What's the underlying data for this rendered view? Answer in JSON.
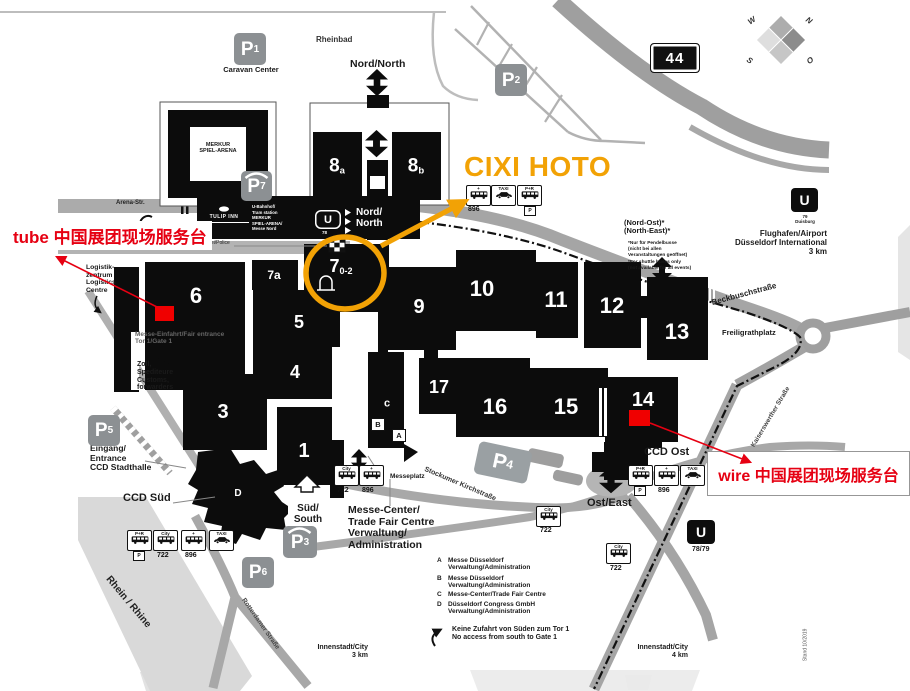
{
  "annotations": {
    "cixi_label": "CIXI HOTO",
    "tube_label": "tube 中国展团现场服务台",
    "wire_label": "wire 中国展团现场服务台"
  },
  "compass": {
    "w": "W",
    "n": "N",
    "s": "S",
    "o": "O"
  },
  "highway": {
    "sign": "44"
  },
  "halls": {
    "h1": "1",
    "h3": "3",
    "h4": "4",
    "h5": "5",
    "h6": "6",
    "h7": "7",
    "h7_sub": "0-2",
    "h7a": "7a",
    "h8": "8",
    "h8a_sub": "a",
    "h8b_sub": "b",
    "h9": "9",
    "h10": "10",
    "h11": "11",
    "h12": "12",
    "h13": "13",
    "h14": "14",
    "h15": "15",
    "h16": "16",
    "h17": "17"
  },
  "buildings": {
    "a": "A",
    "b": "B",
    "c": "c",
    "d": "D"
  },
  "parking": {
    "p": "P",
    "n1": "1",
    "n2": "2",
    "n3": "3",
    "n4": "4",
    "n5": "5",
    "n6": "6",
    "n7": "7",
    "caravan": "Caravan Center"
  },
  "entrances": {
    "north_top": "Nord/North",
    "north_bar": "Nord/\nNorth",
    "south": "Süd/\nSouth",
    "east": "Ost/East"
  },
  "transit": {
    "u": "U",
    "u78": "78",
    "u79": "79\nDuisburg",
    "u7879": "78/79",
    "b722": "722",
    "b896": "896",
    "taxi": "TAXI",
    "pr": "P+R",
    "city": "City",
    "plus": "+",
    "ptag": "P"
  },
  "streets": {
    "arena": "Arena-Str.",
    "heinz": "Heinz-Ingenstau-Str.",
    "messeplatz": "Messeplatz",
    "stockumer": "Stockumer Kirchstraße",
    "rotterdamer": "Rotterdamer Straße",
    "kaiserswerther": "Kaiserswerther Straße",
    "beckbusch": "Beckbuschstraße",
    "freiligrath": "Freiligrathplatz",
    "rhein": "Rhein / Rhine"
  },
  "places": {
    "rheinbad": "Rheinbad",
    "merkur": "MERKUR\nSPIEL-ARENA",
    "tulip": "TULIP INN",
    "station": "U-Bahnhof/\nTram station\nMERKUR\nSPIEL-ARENA/\nMesse Nord",
    "polizei": "Polizei/Police",
    "logistik": "Logistik-\nzentrum\nLogistics\nCentre",
    "fair_entrance": "Messe-Einfahrt/Fair entrance\nTor 1/Gate 1",
    "zoll": "Zoll,\nSpediteure\nCustoms,\nforwarders",
    "eingang": "Eingang/\nEntrance\nCCD Stadthalle",
    "ccd_sued": "CCD Süd",
    "ccd_ost": "CCD Ost",
    "airport": "Flughafen/Airport\nDüsseldorf International\n3 km",
    "city3": "Innenstadt/City\n3 km",
    "city4": "Innenstadt/City\n4 km",
    "stand": "Stand 10/2019"
  },
  "northeast": {
    "title": "(Nord-Ost)*\n(North-East)*",
    "note_de": "*Nur für Pendelbusse\n(nicht bei allen\nVeranstaltungen geöffnet)",
    "note_en": "*For shuttle buses only\n(not available for all events)"
  },
  "legend": {
    "header": "Messe-Center/\nTrade Fair Centre\nVerwaltung/\nAdministration",
    "a_key": "A",
    "a_text": "Messe Düsseldorf\nVerwaltung/Administration",
    "b_key": "B",
    "b_text": "Messe Düsseldorf\nVerwaltung/Administration",
    "c_key": "C",
    "c_text": "Messe-Center/Trade Fair Centre",
    "d_key": "D",
    "d_text": "Düsseldorf Congress GmbH\nVerwaltung/Administration",
    "no_access": "Keine Zufahrt von Süden zum Tor 1\nNo access from south to Gate 1"
  }
}
